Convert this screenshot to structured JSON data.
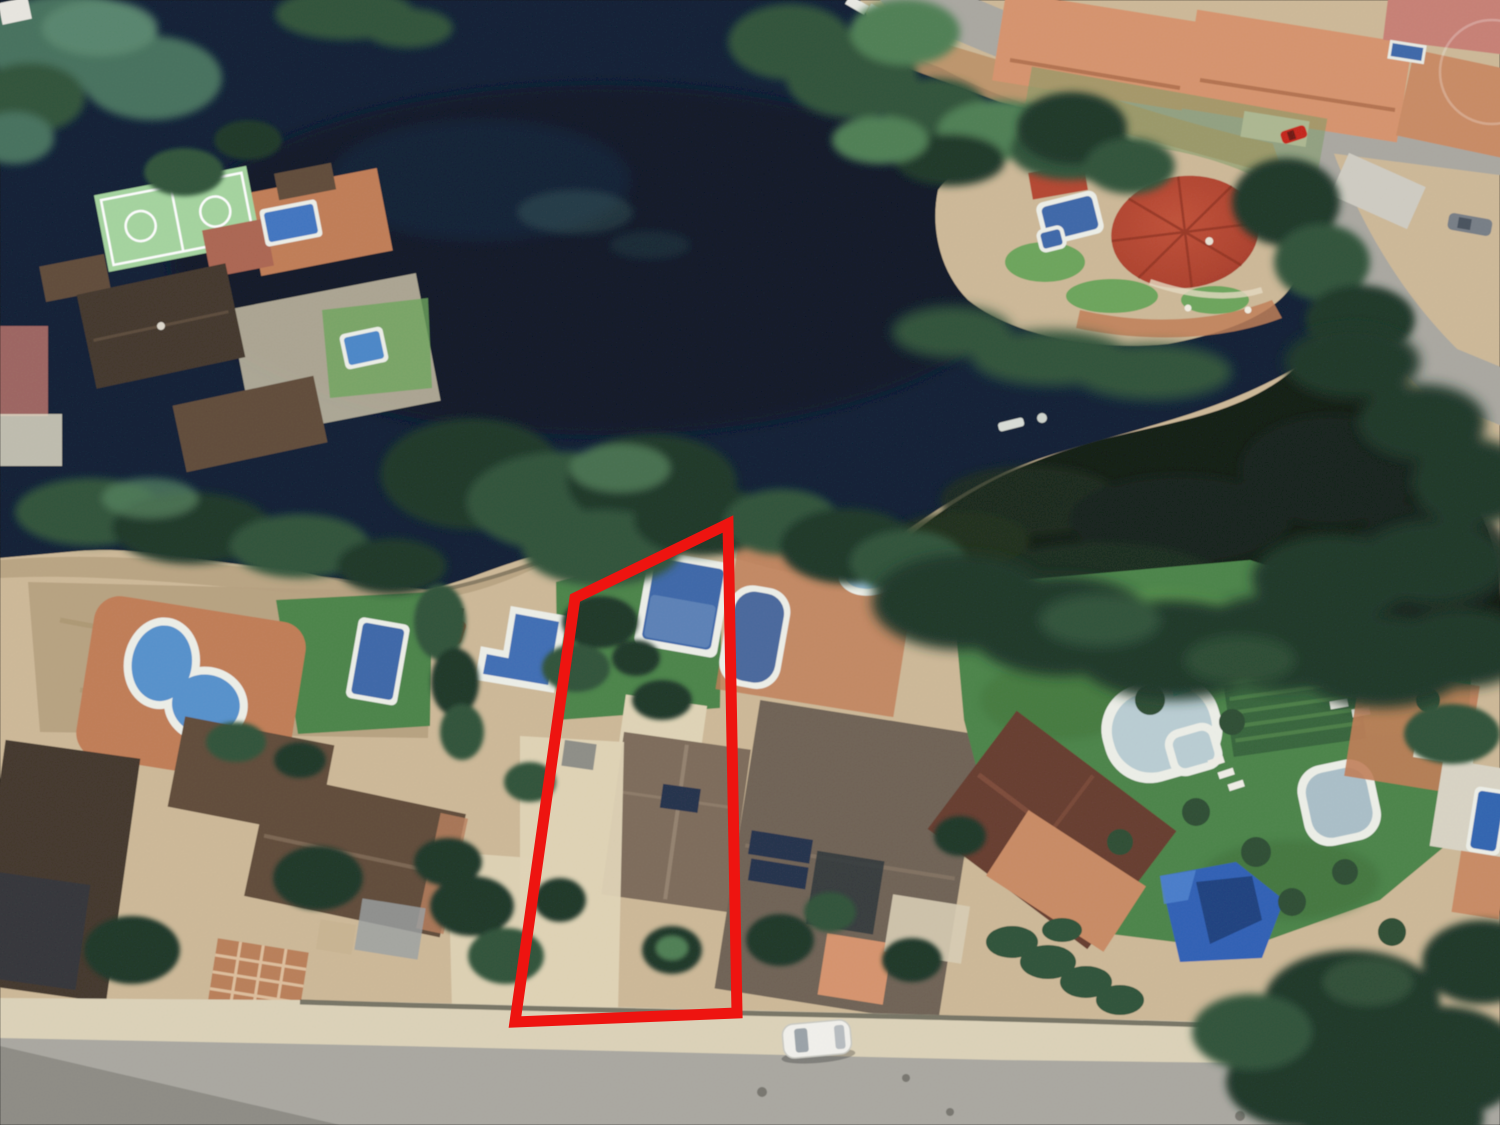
{
  "meta": {
    "title": "Aerial satellite view of lakeside residential plots with red property boundary",
    "image_type": "oblique-aerial-photograph",
    "width_px": 1500,
    "height_px": 1125
  },
  "annotation": {
    "name": "property-boundary",
    "shape": "quadrilateral",
    "points": "728,524 575,598 515,1022 737,1013",
    "color": "#ee1410",
    "stroke_width": "11"
  },
  "palette": {
    "water": "#0d1d33",
    "water_deep": "#0a1528",
    "marsh": "#101b12",
    "sand": "#cdb897",
    "sand_light": "#e0d4b6",
    "sand_dark": "#b5a07e",
    "dirt": "#bb9166",
    "paving_terracotta": "#c07c55",
    "lawn": "#4a8348",
    "lawn_light": "#6ba45a",
    "tree_dark": "#1e3425",
    "tree_mid": "#2d5138",
    "tree_light": "#4d7e53",
    "tree_teal": "#44705b",
    "road_grey": "#a9a7a0",
    "road_dark": "#8d8b84",
    "sidewalk": "#dcd2b8",
    "pool_blue": "#3c66a8",
    "pool_light": "#6489bb",
    "pool_pale": "#b9cdd3",
    "pool_rim": "#edefe8",
    "roof_salmon": "#d6936c",
    "roof_orange": "#c98a63",
    "roof_brown": "#5f4a38",
    "roof_dark": "#41352a",
    "roof_taupe": "#7c6a59",
    "roof_grey": "#6e6154",
    "roof_red": "#b4452f",
    "roof_maroon": "#653b2d",
    "court_green": "#a4d49e",
    "court_red": "#ab6450",
    "white": "#f1efe8",
    "solar_panel": "#22304a",
    "car_white": "#f2f1ec",
    "car_red": "#c52319",
    "car_grey": "#767d85"
  },
  "features": [
    {
      "name": "lake",
      "description": "dark lagoon filling the upper half of the scene"
    },
    {
      "name": "property-boundary",
      "description": "red four-sided outline around a lakeside villa plot with pool, lawn, house and driveway"
    },
    {
      "name": "sports-court",
      "description": "pale green multi-sport court with white markings beside a clay court, top-left"
    },
    {
      "name": "round-pavilion",
      "description": "circular red-roofed pavilion on a sandy lakeside peninsula, upper right"
    },
    {
      "name": "swimming-pools",
      "description": "thirteen pools of blue and pale water scattered across the gardens",
      "count": 13
    },
    {
      "name": "villas",
      "description": "detached houses with terracotta, brown and taupe tiled roofs along the shore road"
    },
    {
      "name": "solar-panels",
      "description": "dark roof-mounted panels on the house right of the outlined plot"
    },
    {
      "name": "roads",
      "description": "grey road junction at top right and a wide grey street along the bottom edge"
    },
    {
      "name": "white-car",
      "description": "white car parked on the bottom street"
    },
    {
      "name": "red-car",
      "description": "small red car on the upper road"
    },
    {
      "name": "grey-car",
      "description": "grey car parked near the top-right junction"
    },
    {
      "name": "tree-cover",
      "description": "dense dark pine and shrub masses along the shoreline and lower right corner"
    },
    {
      "name": "lawns",
      "description": "bright green irrigated gardens with hedges, garden rows and sun loungers right of centre"
    }
  ]
}
